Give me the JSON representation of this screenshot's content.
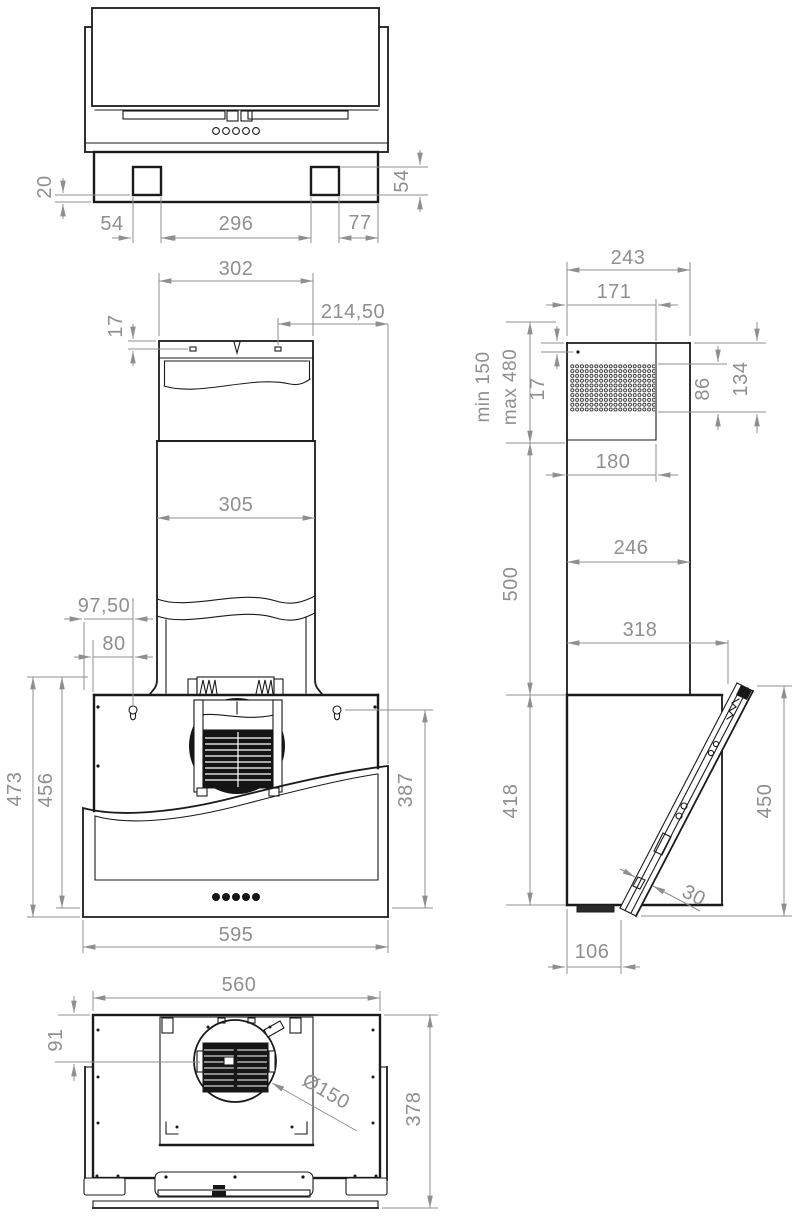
{
  "drawing": {
    "colors": {
      "line": "#1b1b1b",
      "dimension": "#8f8f8f"
    },
    "labels": {
      "top": {
        "h20": "20",
        "w54": "54",
        "w296": "296",
        "w77": "77",
        "v54": "54"
      },
      "front": {
        "w302": "302",
        "off21450": "214,50",
        "h17": "17",
        "w305": "305",
        "off9750": "97,50",
        "off80": "80",
        "h473": "473",
        "h456": "456",
        "h387": "387",
        "w595": "595"
      },
      "side": {
        "w243": "243",
        "w171": "171",
        "min150": "min 150",
        "max480": "max 480",
        "h17": "17",
        "h86": "86",
        "h134": "134",
        "w180": "180",
        "w246": "246",
        "h500": "500",
        "w318": "318",
        "h418": "418",
        "h450": "450",
        "t30": "30",
        "w106": "106"
      },
      "bottom": {
        "w560": "560",
        "h91": "91",
        "dia": "Ø150",
        "h378": "378"
      }
    }
  }
}
